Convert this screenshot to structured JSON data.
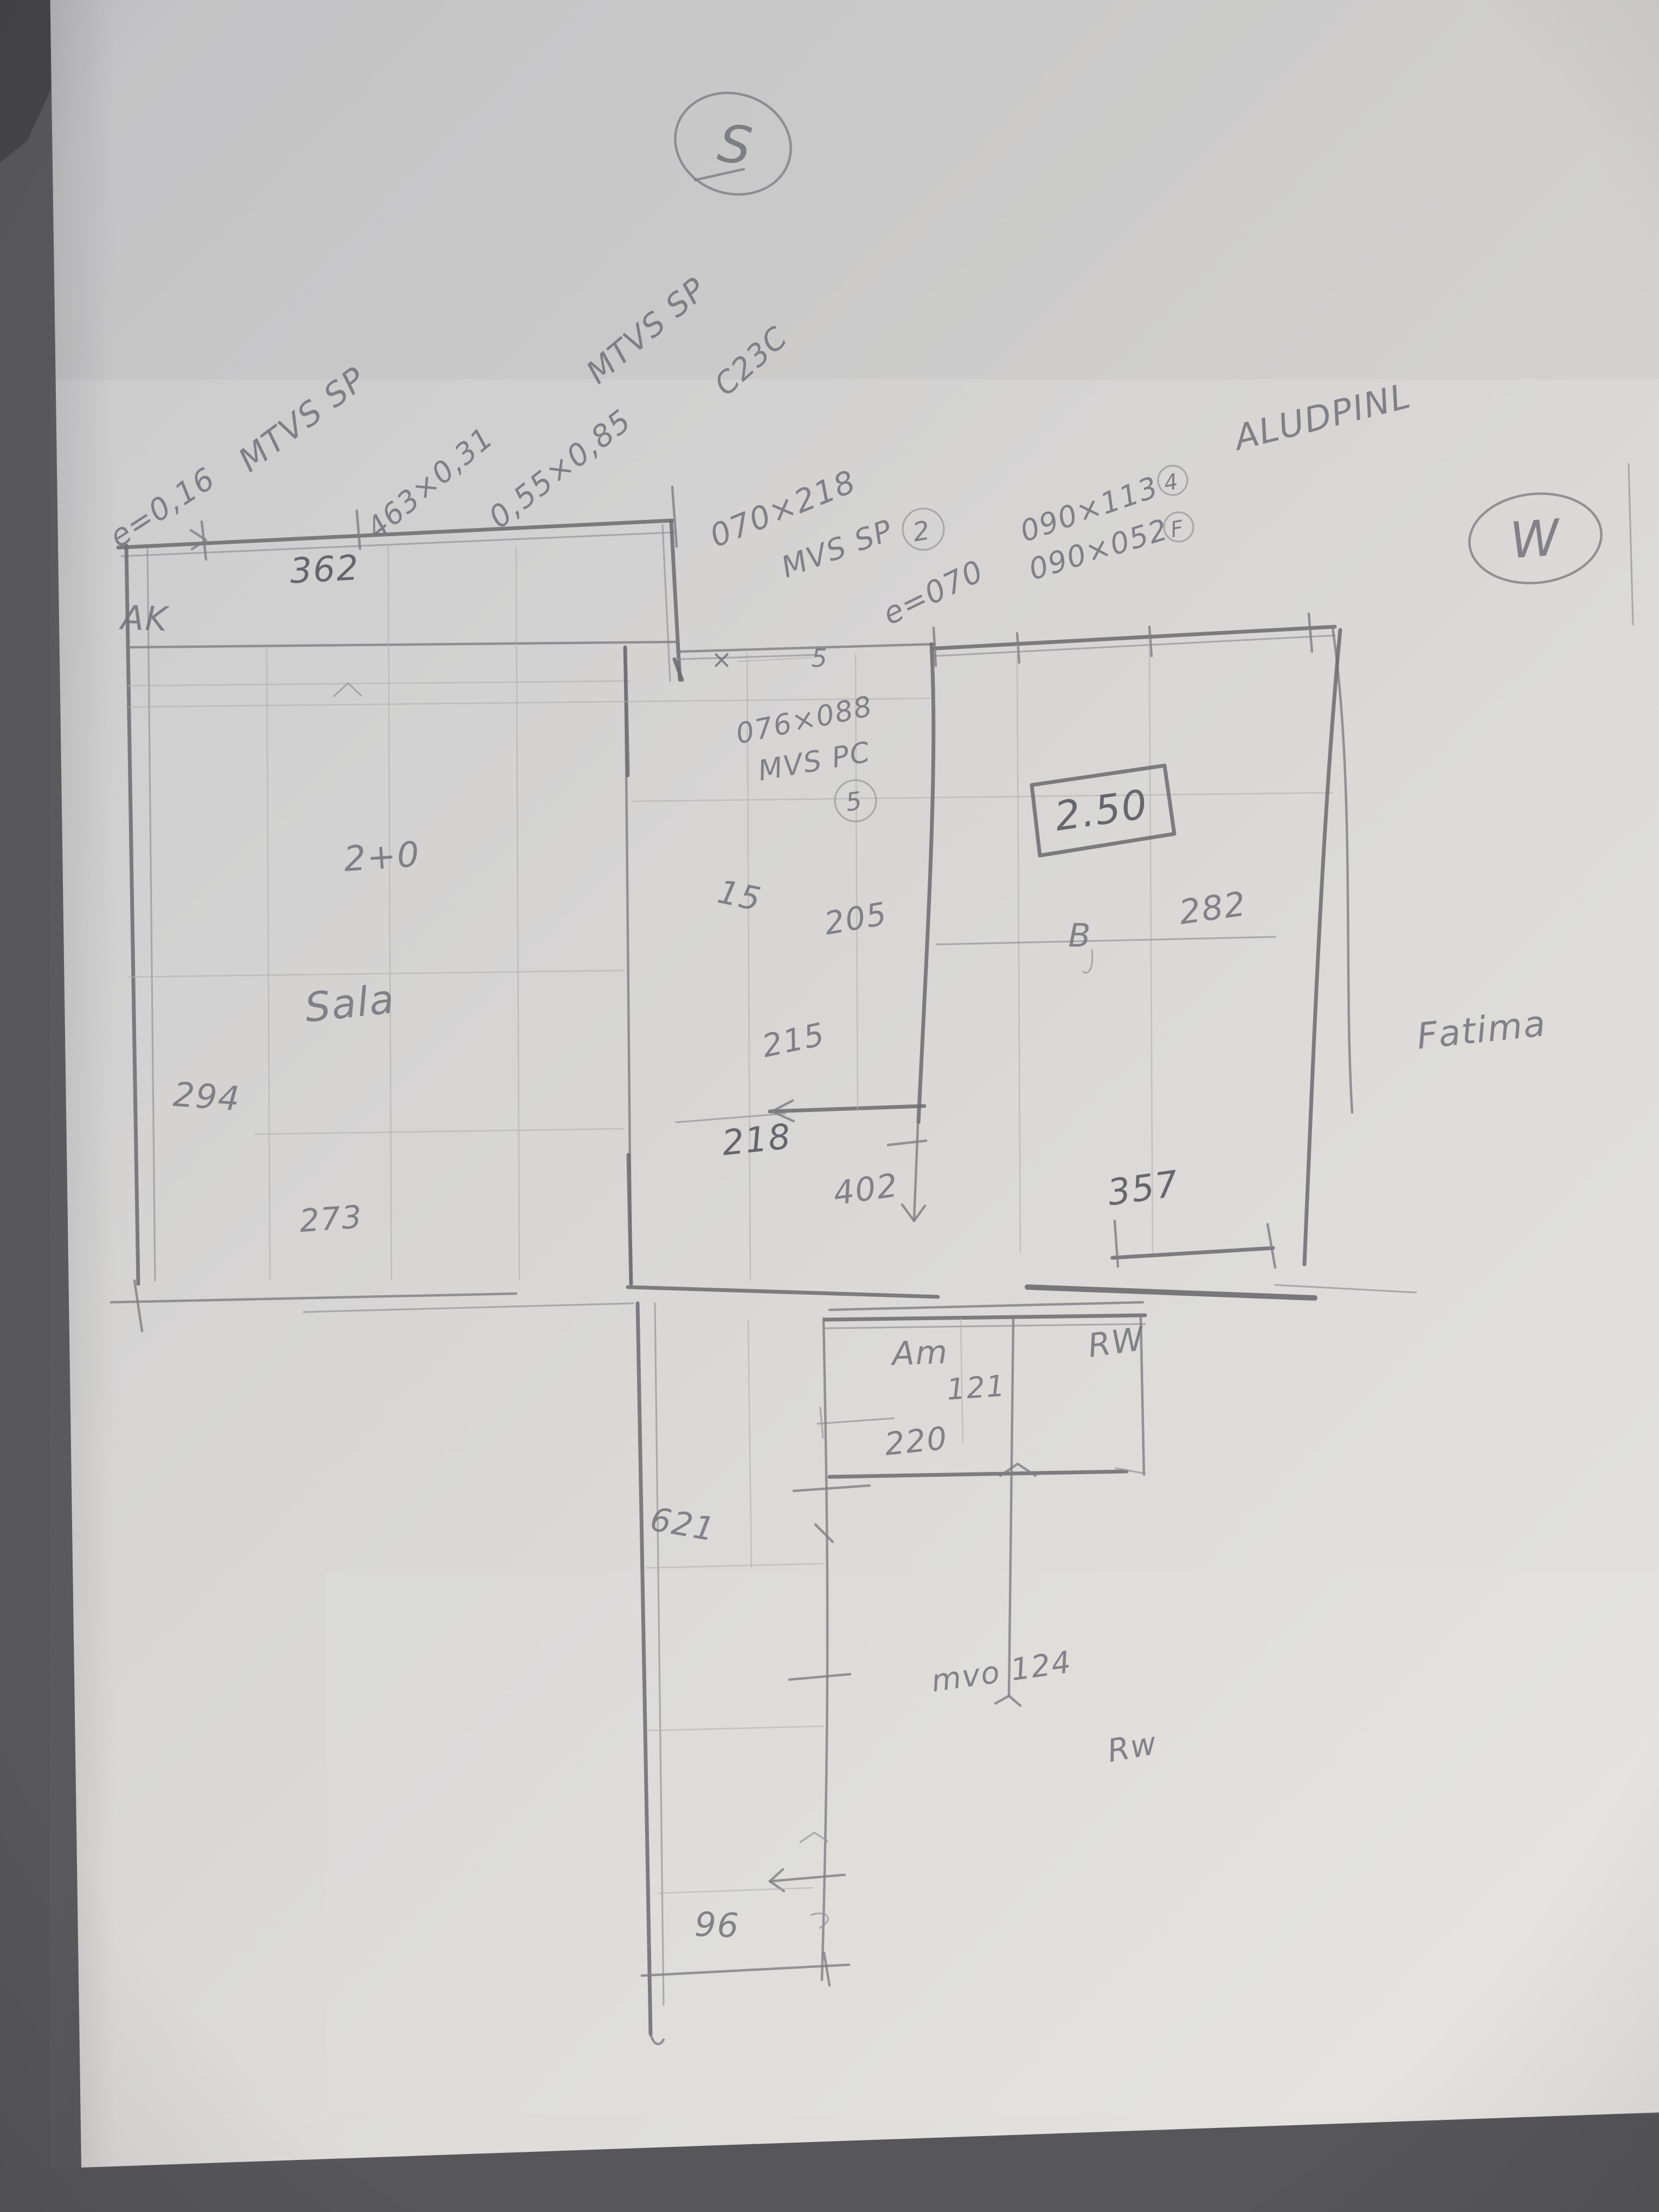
{
  "compass": {
    "south": "S",
    "west": "W"
  },
  "notes": {
    "tl_thickness": "e=0,16",
    "tl_name": "MTVS SP",
    "tl_size": "463×0,31",
    "tm_name": "MTVS SP",
    "tm_size": "0,55×0,85",
    "tm_code": "C23C",
    "door_size": "070×218",
    "door_name": "MVS SP",
    "door_badge": "2",
    "wall_thickness": "e=070",
    "alu_title": "ALUDPINL",
    "alu_size1": "090×113",
    "alu_badge1": "4",
    "alu_size2": "090×052",
    "alu_badge2": "F",
    "win_size": "076×088",
    "win_name": "MVS PC",
    "win_badge": "5",
    "mark_x": "×",
    "mark_5": "5",
    "b_mark": "B",
    "corridor_note": "mvo 124"
  },
  "rooms": {
    "sala": "Sala",
    "am": "Am",
    "fatima": "Fatima",
    "rw_upper": "RW",
    "rw_lower": "Rw",
    "ak": "AK"
  },
  "dims": {
    "top_width": "362",
    "boxed_height": "2.50",
    "left_height": "294",
    "left_bottom": "273",
    "left_inner": "2+0",
    "mid_a": "15",
    "mid_b": "205",
    "mid_c": "215",
    "mid_d": "218",
    "mid_e": "402",
    "right_width": "282",
    "right_bottom": "357",
    "low_width": "220",
    "low_height": "121",
    "corr_a": "621",
    "corr_b": "96"
  }
}
